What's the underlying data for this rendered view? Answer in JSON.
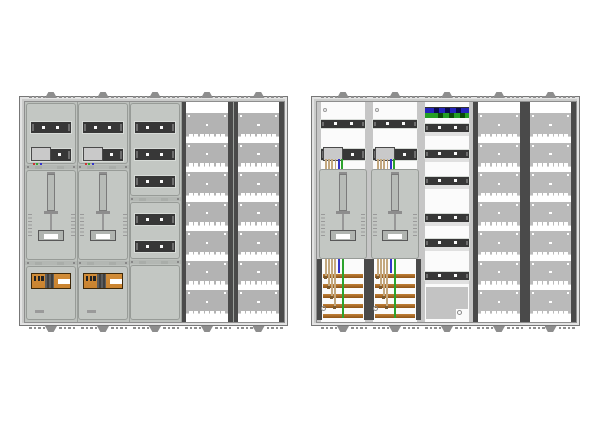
{
  "drawing": {
    "type": "electrical-enclosure-layout",
    "cabinets": [
      {
        "name": "left-cabinet",
        "view": "covered",
        "columns": [
          "meter-field",
          "meter-field",
          "device-field-covered",
          "perforated-field",
          "perforated-field"
        ]
      },
      {
        "name": "right-cabinet",
        "view": "open",
        "columns": [
          "meter-field-open",
          "meter-field-open",
          "device-field-open",
          "perforated-field",
          "perforated-field"
        ]
      }
    ]
  },
  "structure": {
    "columns_per_cabinet": 5,
    "meter_fields_per_cabinet": 2,
    "covered_device_rows_top": 3,
    "covered_device_rows_middle": 2,
    "perforated_rows_per_column": 7,
    "open_din_rails": 6,
    "busbars_per_meter_field": 5,
    "clips_per_edge": 5,
    "teeth_per_separator": 7,
    "meter_tail_wires": [
      "tan",
      "tan",
      "tan",
      "tan",
      "blue",
      "green"
    ],
    "terminal_wire_dot_colors": [
      "#cc3333",
      "#33aa33",
      "#3333cc"
    ]
  },
  "colors": {
    "frame": "#cbcccb",
    "frame_border": "#777777",
    "inner_border": "#8e8e8e",
    "covered_bg": "#bdc1bd",
    "open_bg": "#fbfbfb",
    "panel": "#c3c7c3",
    "panel_border": "#979b97",
    "seam": "#b3b7b3",
    "dark": "#373737",
    "row_frame": "#d7dbd7",
    "rail_dot": "#fafafa",
    "perf_base": "#b3b3b3",
    "perf_light": "#bababa",
    "rail": "#4a4a4a",
    "light_rail": "#c6c6c6",
    "sls_orange": "#c9832f",
    "sls_orange_light": "#d18c38",
    "copper": "#a96a23",
    "copper_dark": "#8f5518",
    "copper_light": "#c08038",
    "wire_tan": "#c3a87f",
    "wire_blue": "#3434cb",
    "wire_green": "#2da32d",
    "neutral_blue": "#2424bc",
    "pe_green": "#24a024",
    "clip": "#8d8d8d"
  }
}
